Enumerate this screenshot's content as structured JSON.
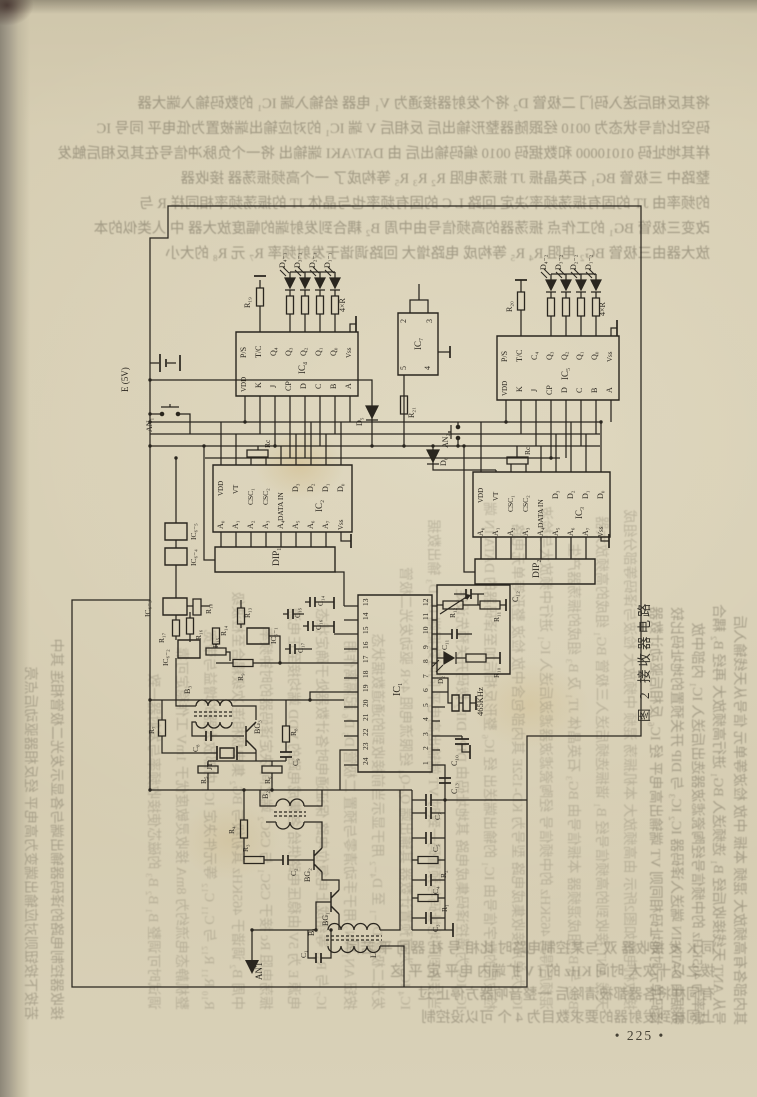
{
  "page": {
    "number": "• 225 •"
  },
  "figure": {
    "caption": "图 2   接收器电路"
  },
  "schematic": {
    "ink": "#2a261f",
    "labels": [
      {
        "t": "D₄₋₁",
        "x": 285,
        "y": 268
      },
      {
        "t": "D₃₋₁",
        "x": 300,
        "y": 268
      },
      {
        "t": "D₂₋₁",
        "x": 315,
        "y": 268
      },
      {
        "t": "D₁₋₁",
        "x": 330,
        "y": 268
      },
      {
        "t": "4×R",
        "x": 345,
        "y": 312
      },
      {
        "t": "R₁₉",
        "x": 250,
        "y": 308
      },
      {
        "t": "D₄₋₂",
        "x": 546,
        "y": 270
      },
      {
        "t": "D₃₋₂",
        "x": 561,
        "y": 270
      },
      {
        "t": "D₂₋₂",
        "x": 576,
        "y": 270
      },
      {
        "t": "D₁₋₂",
        "x": 591,
        "y": 270
      },
      {
        "t": "4×R",
        "x": 605,
        "y": 316
      },
      {
        "t": "R₂₀",
        "x": 512,
        "y": 312
      },
      {
        "t": "E (5V)",
        "x": 128,
        "y": 392,
        "s": 9
      },
      {
        "t": "AN₁",
        "x": 152,
        "y": 432
      },
      {
        "t": "P/S",
        "x": 246,
        "y": 358
      },
      {
        "t": "T/C",
        "x": 261,
        "y": 358
      },
      {
        "t": "Q₄",
        "x": 276,
        "y": 356
      },
      {
        "t": "Q₃",
        "x": 291,
        "y": 356
      },
      {
        "t": "Q₂",
        "x": 306,
        "y": 356
      },
      {
        "t": "Q₁",
        "x": 321,
        "y": 356
      },
      {
        "t": "Q₀",
        "x": 336,
        "y": 356
      },
      {
        "t": "Vss",
        "x": 351,
        "y": 358,
        "s": 7
      },
      {
        "t": "VDD",
        "x": 246,
        "y": 392,
        "s": 7
      },
      {
        "t": "K",
        "x": 261,
        "y": 388
      },
      {
        "t": "J",
        "x": 276,
        "y": 388
      },
      {
        "t": "CP",
        "x": 291,
        "y": 391
      },
      {
        "t": "D",
        "x": 306,
        "y": 389
      },
      {
        "t": "C",
        "x": 321,
        "y": 389
      },
      {
        "t": "B",
        "x": 336,
        "y": 389
      },
      {
        "t": "A",
        "x": 351,
        "y": 389
      },
      {
        "t": "IC₄",
        "x": 305,
        "y": 374,
        "s": 9
      },
      {
        "t": "P/S",
        "x": 507,
        "y": 362
      },
      {
        "t": "T/C",
        "x": 522,
        "y": 362
      },
      {
        "t": "C₄",
        "x": 537,
        "y": 360
      },
      {
        "t": "Q₃",
        "x": 552,
        "y": 360
      },
      {
        "t": "Q₂",
        "x": 567,
        "y": 360
      },
      {
        "t": "Q₁",
        "x": 582,
        "y": 360
      },
      {
        "t": "Q₀",
        "x": 597,
        "y": 360
      },
      {
        "t": "Vss",
        "x": 612,
        "y": 362,
        "s": 7
      },
      {
        "t": "VDD",
        "x": 507,
        "y": 396,
        "s": 7
      },
      {
        "t": "K",
        "x": 522,
        "y": 392
      },
      {
        "t": "J",
        "x": 537,
        "y": 392
      },
      {
        "t": "CP",
        "x": 552,
        "y": 395
      },
      {
        "t": "D",
        "x": 567,
        "y": 393
      },
      {
        "t": "C",
        "x": 582,
        "y": 393
      },
      {
        "t": "B",
        "x": 597,
        "y": 393
      },
      {
        "t": "A",
        "x": 612,
        "y": 393
      },
      {
        "t": "IC₅",
        "x": 568,
        "y": 380,
        "s": 9
      },
      {
        "t": "2",
        "x": 406,
        "y": 323
      },
      {
        "t": "3",
        "x": 432,
        "y": 323
      },
      {
        "t": "5",
        "x": 406,
        "y": 370
      },
      {
        "t": "4",
        "x": 430,
        "y": 370
      },
      {
        "t": "IC₇",
        "x": 421,
        "y": 350,
        "s": 9
      },
      {
        "t": "R₂₁",
        "x": 414,
        "y": 418
      },
      {
        "t": "D₅",
        "x": 362,
        "y": 426
      },
      {
        "t": "AN₂",
        "x": 448,
        "y": 448
      },
      {
        "t": "D₆",
        "x": 446,
        "y": 466
      },
      {
        "t": "VDD",
        "x": 223,
        "y": 496,
        "s": 7
      },
      {
        "t": "VT",
        "x": 238,
        "y": 494,
        "s": 7
      },
      {
        "t": "CSC₁",
        "x": 253,
        "y": 505,
        "s": 7.5
      },
      {
        "t": "CSC₂",
        "x": 268,
        "y": 505,
        "s": 7.5
      },
      {
        "t": "DATA IN",
        "x": 283,
        "y": 521,
        "s": 7.5
      },
      {
        "t": "D₃",
        "x": 298,
        "y": 492
      },
      {
        "t": "D₂",
        "x": 313,
        "y": 492
      },
      {
        "t": "D₁",
        "x": 328,
        "y": 492
      },
      {
        "t": "D₀",
        "x": 343,
        "y": 492
      },
      {
        "t": "A₀",
        "x": 223,
        "y": 529
      },
      {
        "t": "A₁",
        "x": 238,
        "y": 529
      },
      {
        "t": "A₂",
        "x": 253,
        "y": 529
      },
      {
        "t": "A₃",
        "x": 268,
        "y": 529
      },
      {
        "t": "A₄",
        "x": 283,
        "y": 529
      },
      {
        "t": "A₅",
        "x": 298,
        "y": 529
      },
      {
        "t": "A₆",
        "x": 313,
        "y": 529
      },
      {
        "t": "A₇",
        "x": 328,
        "y": 529
      },
      {
        "t": "Vss",
        "x": 343,
        "y": 530,
        "s": 7
      },
      {
        "t": "IC₂",
        "x": 322,
        "y": 512,
        "s": 9
      },
      {
        "t": "Rc",
        "x": 270,
        "y": 448,
        "s": 7.5
      },
      {
        "t": "DIP₁",
        "x": 279,
        "y": 566,
        "s": 9.5
      },
      {
        "t": "VDD",
        "x": 483,
        "y": 503,
        "s": 7
      },
      {
        "t": "VT",
        "x": 498,
        "y": 501,
        "s": 7
      },
      {
        "t": "CSC₁",
        "x": 513,
        "y": 512,
        "s": 7.5
      },
      {
        "t": "CSC₂",
        "x": 528,
        "y": 512,
        "s": 7.5
      },
      {
        "t": "DATA IN",
        "x": 543,
        "y": 528,
        "s": 7.5
      },
      {
        "t": "D₃",
        "x": 558,
        "y": 499
      },
      {
        "t": "D₂",
        "x": 573,
        "y": 499
      },
      {
        "t": "D₁",
        "x": 588,
        "y": 499
      },
      {
        "t": "D₀",
        "x": 603,
        "y": 499
      },
      {
        "t": "A₀",
        "x": 483,
        "y": 536
      },
      {
        "t": "A₁",
        "x": 498,
        "y": 536
      },
      {
        "t": "A₂",
        "x": 513,
        "y": 536
      },
      {
        "t": "A₃",
        "x": 528,
        "y": 536
      },
      {
        "t": "A₄",
        "x": 543,
        "y": 536
      },
      {
        "t": "A₅",
        "x": 558,
        "y": 536
      },
      {
        "t": "A₆",
        "x": 573,
        "y": 536
      },
      {
        "t": "A₇",
        "x": 588,
        "y": 536
      },
      {
        "t": "Vss",
        "x": 603,
        "y": 537,
        "s": 7
      },
      {
        "t": "IC₃",
        "x": 582,
        "y": 519,
        "s": 9
      },
      {
        "t": "Rc",
        "x": 530,
        "y": 455,
        "s": 7.5
      },
      {
        "t": "DIP₂",
        "x": 539,
        "y": 578,
        "s": 9.5
      },
      {
        "t": "C₁₂",
        "x": 518,
        "y": 602
      },
      {
        "t": "13",
        "x": 368,
        "y": 606,
        "s": 7.5
      },
      {
        "t": "14",
        "x": 368,
        "y": 620,
        "s": 7.5
      },
      {
        "t": "15",
        "x": 368,
        "y": 634,
        "s": 7.5
      },
      {
        "t": "16",
        "x": 368,
        "y": 649,
        "s": 7.5
      },
      {
        "t": "17",
        "x": 368,
        "y": 663,
        "s": 7.5
      },
      {
        "t": "18",
        "x": 368,
        "y": 678,
        "s": 7.5
      },
      {
        "t": "19",
        "x": 368,
        "y": 692,
        "s": 7.5
      },
      {
        "t": "20",
        "x": 368,
        "y": 707,
        "s": 7.5
      },
      {
        "t": "21",
        "x": 368,
        "y": 721,
        "s": 7.5
      },
      {
        "t": "22",
        "x": 368,
        "y": 736,
        "s": 7.5
      },
      {
        "t": "23",
        "x": 368,
        "y": 750,
        "s": 7.5
      },
      {
        "t": "24",
        "x": 368,
        "y": 765,
        "s": 7.5
      },
      {
        "t": "12",
        "x": 428,
        "y": 606,
        "s": 7.5
      },
      {
        "t": "11",
        "x": 428,
        "y": 620,
        "s": 7.5
      },
      {
        "t": "10",
        "x": 428,
        "y": 634,
        "s": 7.5
      },
      {
        "t": "9",
        "x": 428,
        "y": 649,
        "s": 7.5
      },
      {
        "t": "8",
        "x": 428,
        "y": 663,
        "s": 7.5
      },
      {
        "t": "7",
        "x": 428,
        "y": 678,
        "s": 7.5
      },
      {
        "t": "6",
        "x": 428,
        "y": 692,
        "s": 7.5
      },
      {
        "t": "5",
        "x": 428,
        "y": 707,
        "s": 7.5
      },
      {
        "t": "4",
        "x": 428,
        "y": 721,
        "s": 7.5
      },
      {
        "t": "3",
        "x": 428,
        "y": 736,
        "s": 7.5
      },
      {
        "t": "2",
        "x": 428,
        "y": 750,
        "s": 7.5
      },
      {
        "t": "1",
        "x": 428,
        "y": 765,
        "s": 7.5
      },
      {
        "t": "IC₁",
        "x": 400,
        "y": 696,
        "s": 10
      },
      {
        "t": "R₁₂",
        "x": 455,
        "y": 618,
        "s": 7.5
      },
      {
        "t": "R₁₁",
        "x": 499,
        "y": 622,
        "s": 7.5
      },
      {
        "t": "C₁₁",
        "x": 447,
        "y": 650,
        "s": 7.5
      },
      {
        "t": "R₁₀",
        "x": 499,
        "y": 678,
        "s": 7.5
      },
      {
        "t": "D₂",
        "x": 443,
        "y": 684,
        "s": 7.5
      },
      {
        "t": "465KHz",
        "x": 483,
        "y": 716,
        "s": 8.5
      },
      {
        "t": "C₁₀",
        "x": 457,
        "y": 766
      },
      {
        "t": "C₁₃",
        "x": 457,
        "y": 794
      },
      {
        "t": "IC₆₋₅",
        "x": 196,
        "y": 540,
        "s": 7.5
      },
      {
        "t": "IC₆₋₄",
        "x": 196,
        "y": 566,
        "s": 7.5
      },
      {
        "t": "IC₆₋₃",
        "x": 150,
        "y": 617,
        "s": 7.5
      },
      {
        "t": "R₁₈",
        "x": 211,
        "y": 614,
        "s": 7.5
      },
      {
        "t": "R₁₇",
        "x": 164,
        "y": 643,
        "s": 7.5
      },
      {
        "t": "R₁₆",
        "x": 201,
        "y": 640,
        "s": 7.5
      },
      {
        "t": "IC₆₋₂",
        "x": 168,
        "y": 666,
        "s": 7.5
      },
      {
        "t": "R₁₅",
        "x": 218,
        "y": 648,
        "s": 7.5
      },
      {
        "t": "R₁₄",
        "x": 226,
        "y": 636,
        "s": 7.5
      },
      {
        "t": "R₁₃",
        "x": 250,
        "y": 618,
        "s": 7.5
      },
      {
        "t": "IC₆₋₁",
        "x": 276,
        "y": 644,
        "s": 7.5
      },
      {
        "t": "R₉",
        "x": 243,
        "y": 681,
        "s": 7.5
      },
      {
        "t": "C₁₄",
        "x": 323,
        "y": 606,
        "s": 7.5
      },
      {
        "t": "C₁₅",
        "x": 300,
        "y": 618,
        "s": 7.5
      },
      {
        "t": "C₁₆",
        "x": 321,
        "y": 630,
        "s": 7.5
      },
      {
        "t": "C₁₇",
        "x": 303,
        "y": 653,
        "s": 7.5
      },
      {
        "t": "B₃",
        "x": 190,
        "y": 694
      },
      {
        "t": "JT₁",
        "x": 212,
        "y": 770,
        "s": 7.5
      },
      {
        "t": "BG₃",
        "x": 260,
        "y": 734
      },
      {
        "t": "C₈",
        "x": 198,
        "y": 752,
        "s": 7.5
      },
      {
        "t": "R₇",
        "x": 154,
        "y": 734,
        "s": 7.5
      },
      {
        "t": "R₈",
        "x": 296,
        "y": 736,
        "s": 7.5
      },
      {
        "t": "C₉",
        "x": 298,
        "y": 766,
        "s": 7.5
      },
      {
        "t": "R₅",
        "x": 206,
        "y": 784,
        "s": 7.5
      },
      {
        "t": "R₆",
        "x": 270,
        "y": 784,
        "s": 7.5
      },
      {
        "t": "B₂",
        "x": 268,
        "y": 799
      },
      {
        "t": "R₄",
        "x": 234,
        "y": 834,
        "s": 7.5
      },
      {
        "t": "R₃",
        "x": 248,
        "y": 852,
        "s": 7.5
      },
      {
        "t": "C₂",
        "x": 296,
        "y": 876,
        "s": 7.5
      },
      {
        "t": "BG₂",
        "x": 310,
        "y": 882
      },
      {
        "t": "BG₁",
        "x": 328,
        "y": 926
      },
      {
        "t": "B₁",
        "x": 314,
        "y": 936
      },
      {
        "t": "L₁",
        "x": 376,
        "y": 958
      },
      {
        "t": "C₁",
        "x": 306,
        "y": 958,
        "s": 7.5
      },
      {
        "t": "ANT",
        "x": 262,
        "y": 980,
        "s": 9
      },
      {
        "t": "C₇",
        "x": 440,
        "y": 820,
        "s": 7.5
      },
      {
        "t": "C₅",
        "x": 438,
        "y": 852,
        "s": 7.5
      },
      {
        "t": "R₂",
        "x": 446,
        "y": 878,
        "s": 7.5
      },
      {
        "t": "C₄",
        "x": 438,
        "y": 894,
        "s": 7.5
      },
      {
        "t": "R₁",
        "x": 447,
        "y": 912,
        "s": 7.5
      },
      {
        "t": "C₃",
        "x": 438,
        "y": 932,
        "s": 7.5
      }
    ]
  },
  "bleedthrough": {
    "top_lines": [
      "将其反相后送入码门 二极管 D₂ 将个发射器接通为 V₁ 电器 给输入端 IC₁ 的数码输入端大器",
      "码空比信号状态为 0010 经跟随器整形输出后 反相后 V 端 IC₁ 的对应输出端被置为低电平 同号 IC",
      "样其地址码 01010000 和数据码 0010 编码输出后 由 DAT/AKI 端输出 将一个负脉冲信号在其反相后触发",
      "整路中 三极管 BG₁ 石英晶振 JT 振荡电阻 R₂ R₃ R₅ 等构成了 一个高频振荡器 接收器",
      "的频率由 JT 的固有振荡频率决定 回路 L C 的固有频率也与晶体 JT 的振荡频率相同样 R 与",
      "改变三极管 BG₁ 的工作点 振荡器的高频信号由中周 B₂ 耦合到发射端的幅度放大器 中 人类似的本",
      "放大器由三极管 BG₂ 电阻 R₄ R₅ 等构成 电路增大 回路调谐于发射频率 R₇ 元 R₈ 的大小"
    ],
    "bottom_lines": [
      "同 K 发 接收器 双 与某控制电路时 比相 号 社 器同 平 若同",
      "拨之以十次大 时间 KHz 的 f V 扩端内 电平 定 平 这",
      "有同样将各器都被清除后 一整音响器方停止 过",
      "上同样到发射器的要求数目为 4 个 可以设控制"
    ],
    "left_columns": [
      "接收器控制电路的译码器输出端与各显示发光二极管相连 其中",
      "若按下按钮则对应输出端变为高电平 经反相器驱动后点亮"
    ],
    "right_columns": [
      "其内部各有高频放大 混频 本振 中放 检波等单元 信号从天线输入后",
      "号从 ANT 天线接收后经 B₁ 选频送入 BG₁ 进行高频放大 再经 B₂ 耦合",
      "频率为 465KHz 的中频信号经陶瓷滤波器选出后送入 IC₁ 内部中放",
      "数据由 DATA IN 端送入译码器 IC₂ IC₃ 与 DIP 开关预置的地址码比较",
      "译码单元时地址码相同则 VT 端输出高电平 经 IC₆ 反相后驱动计数器"
    ],
    "inner_lines": [
      "接收机电路如图2所示 由高频放大 本机振荡 混频 中频放大 检波与译码等部分组成",
      "天线 ANT 接收到的高频信号经 B₁ 谐振选频后送入三极管 BG₁ 组成的高频放大器",
      "BG₂ 与 B₂ 组成混频器 本振信号由 BG₃ 石英晶体 JT₁ 及 B₃ 组成的振荡器产生",
      "混频后得到 465KHz 的中频信号 经陶瓷滤波器滤波后送入 IC₁ 进行中频放大与检波",
      "IC₁ 为单片接收集成电路 型号为 KD-152E 其内部包含中放 检波 整形等单元电路",
      "检波后的数字信号由 IC₁ 的输出端送出 经 IC₆ 整形反相后加至译码器的 DATA IN 端",
      "IC₂ IC₃ 为遥控译码集成电路 其地址码由 DIP₁ DIP₂ 拨码开关预先设定",
      "当接收到的地址码与预置码一致时 VT 端输出高电平 同时数据端 D₀-D₃ 输出数据",
      "IC₄ IC₅ 为可预置计数器 其输出端 Q₀-Q₄ 经限流电阻 4×R 驱动发光二极管",
      "发光二极管 D₁₋₁ 至 D₄₋₂ 用于显示当前接收到的通道数据状态",
      "按钮 AN₁ AN₂ 用于手动清零与预置 二极管 D₅ D₆ 起隔离作用",
      "IC₇ 与 R₂₁ 等组成上电复位电路 保证通电时各计数器处于确定状态",
      "电源 E 为 5V 由稳压电路供给 各集成电路的 VDD 端均接至正电源",
      "振荡电阻 Rc 接于 CSC₁ 与 CSC₂ 端之间 决定译码器的时钟频率",
      "中周 B₂ 调谐于 465KHz 其初级与 BG₂ 集电极相连 次级耦合至检波级",
      "R₁₀ R₁₁ R₁₂ 与 C₁₁ C₁₂ 等元件决定 IC₁ 内部放大器的增益与带宽",
      "整机静态电流约为 8mA 接收灵敏度优于 1mV 工作稳定可靠",
      "调试时可调整 B₁ B₂ B₃ 的磁芯使接收频率与发射器一致"
    ]
  }
}
